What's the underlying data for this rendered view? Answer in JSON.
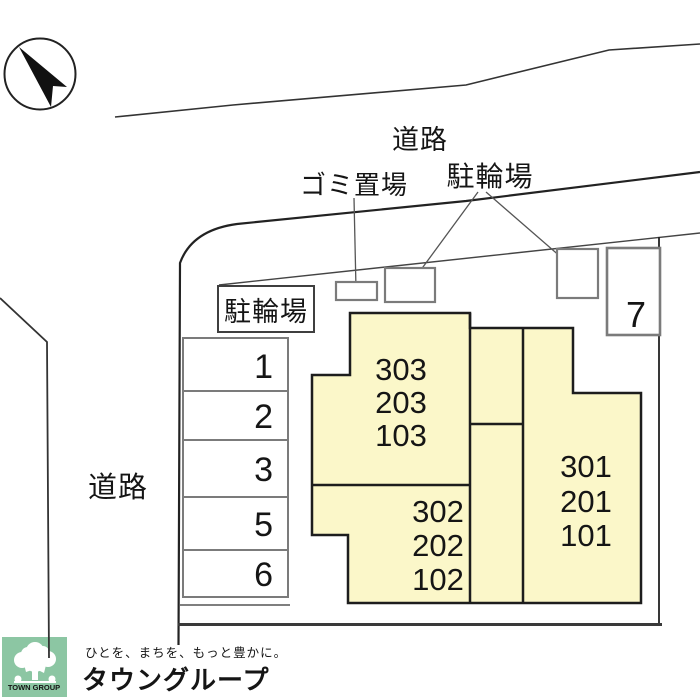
{
  "plan": {
    "labels": {
      "road_top": "道路",
      "road_left": "道路",
      "garbage": "ゴミ置場",
      "bicycle_parking_top": "駐輪場",
      "bicycle_parking_box": "駐輪場"
    },
    "parking": {
      "spaces": [
        "1",
        "2",
        "3",
        "5",
        "6"
      ],
      "space_right": "7"
    },
    "building": {
      "fill_color": "#FBF7C9",
      "unit_stacks": [
        {
          "name": "left-stack",
          "units": [
            "303",
            "203",
            "103"
          ]
        },
        {
          "name": "middle-stack",
          "units": [
            "302",
            "202",
            "102"
          ]
        },
        {
          "name": "right-stack",
          "units": [
            "301",
            "201",
            "101"
          ]
        }
      ]
    }
  },
  "footer": {
    "logo_text": "TOWN GROUP",
    "logo_color": "#8CC6A3",
    "tagline": "ひとを、まちを、もっと豊かに。",
    "tagline_color": "#A5C9BF",
    "brand": "タウングループ",
    "brand_color": "#74B7A6"
  }
}
